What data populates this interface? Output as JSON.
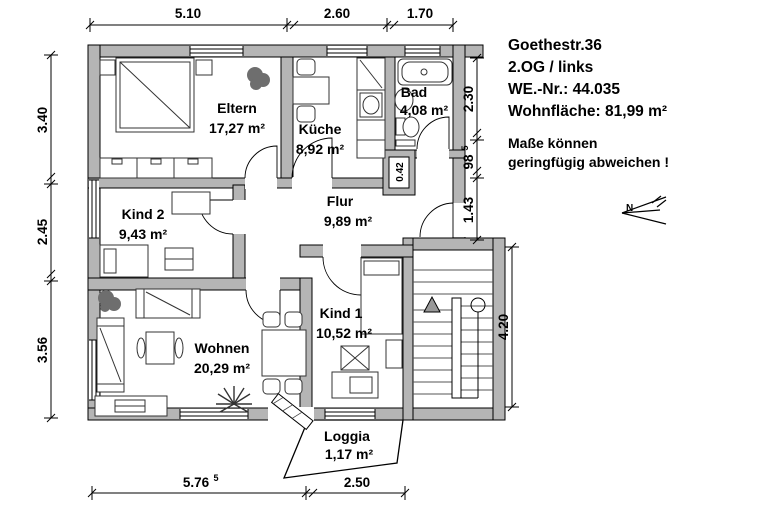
{
  "header": {
    "address": "Goethestr.36",
    "floor": "2.OG / links",
    "unit": "WE.-Nr.: 44.035",
    "area": "Wohnfläche: 81,99 m²",
    "note1": "Maße können",
    "note2": "geringfügig abweichen !"
  },
  "rooms": {
    "eltern": {
      "name": "Eltern",
      "area": "17,27 m²"
    },
    "kueche": {
      "name": "Küche",
      "area": "8,92 m²"
    },
    "bad": {
      "name": "Bad",
      "area": "4,08 m²"
    },
    "kind2": {
      "name": "Kind 2",
      "area": "9,43 m²"
    },
    "flur": {
      "name": "Flur",
      "area": "9,89 m²"
    },
    "kind1": {
      "name": "Kind 1",
      "area": "10,52 m²"
    },
    "wohnen": {
      "name": "Wohnen",
      "area": "20,29 m²"
    },
    "loggia": {
      "name": "Loggia",
      "area": "1,17 m²"
    }
  },
  "dims": {
    "top": [
      "5.10",
      "2.60",
      "1.70"
    ],
    "left": [
      "3.40",
      "2.45",
      "3.56"
    ],
    "right_upper": [
      "2.30",
      "98",
      "1.43"
    ],
    "right_sup": "5",
    "right_lower": "4.20",
    "bottom": [
      "5.76",
      "2.50"
    ],
    "bottom_sup": "5",
    "shaft": "0.42"
  },
  "compass": {
    "label": "N"
  },
  "colors": {
    "wall": "#b5b5b5",
    "outline": "#000000",
    "background": "#ffffff"
  }
}
